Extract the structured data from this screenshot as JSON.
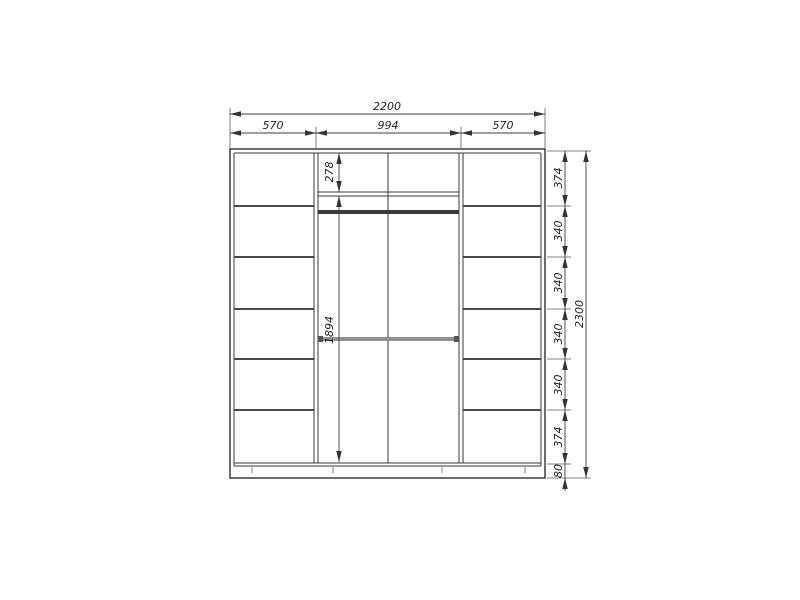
{
  "drawing": {
    "type": "wardrobe-front-elevation",
    "widths": {
      "overall": "2200",
      "left": "570",
      "middle": "994",
      "right": "570"
    },
    "middle_dims": {
      "top_section": "278",
      "hanging_section": "1894"
    },
    "heights": {
      "segments": [
        "374",
        "340",
        "340",
        "340",
        "340",
        "374",
        "80"
      ],
      "overall": "2300"
    },
    "colors": {
      "line": "#2f2f2f",
      "rod_dark": "#3a3a3a",
      "rod_grey": "#909090",
      "background": "#ffffff"
    }
  }
}
